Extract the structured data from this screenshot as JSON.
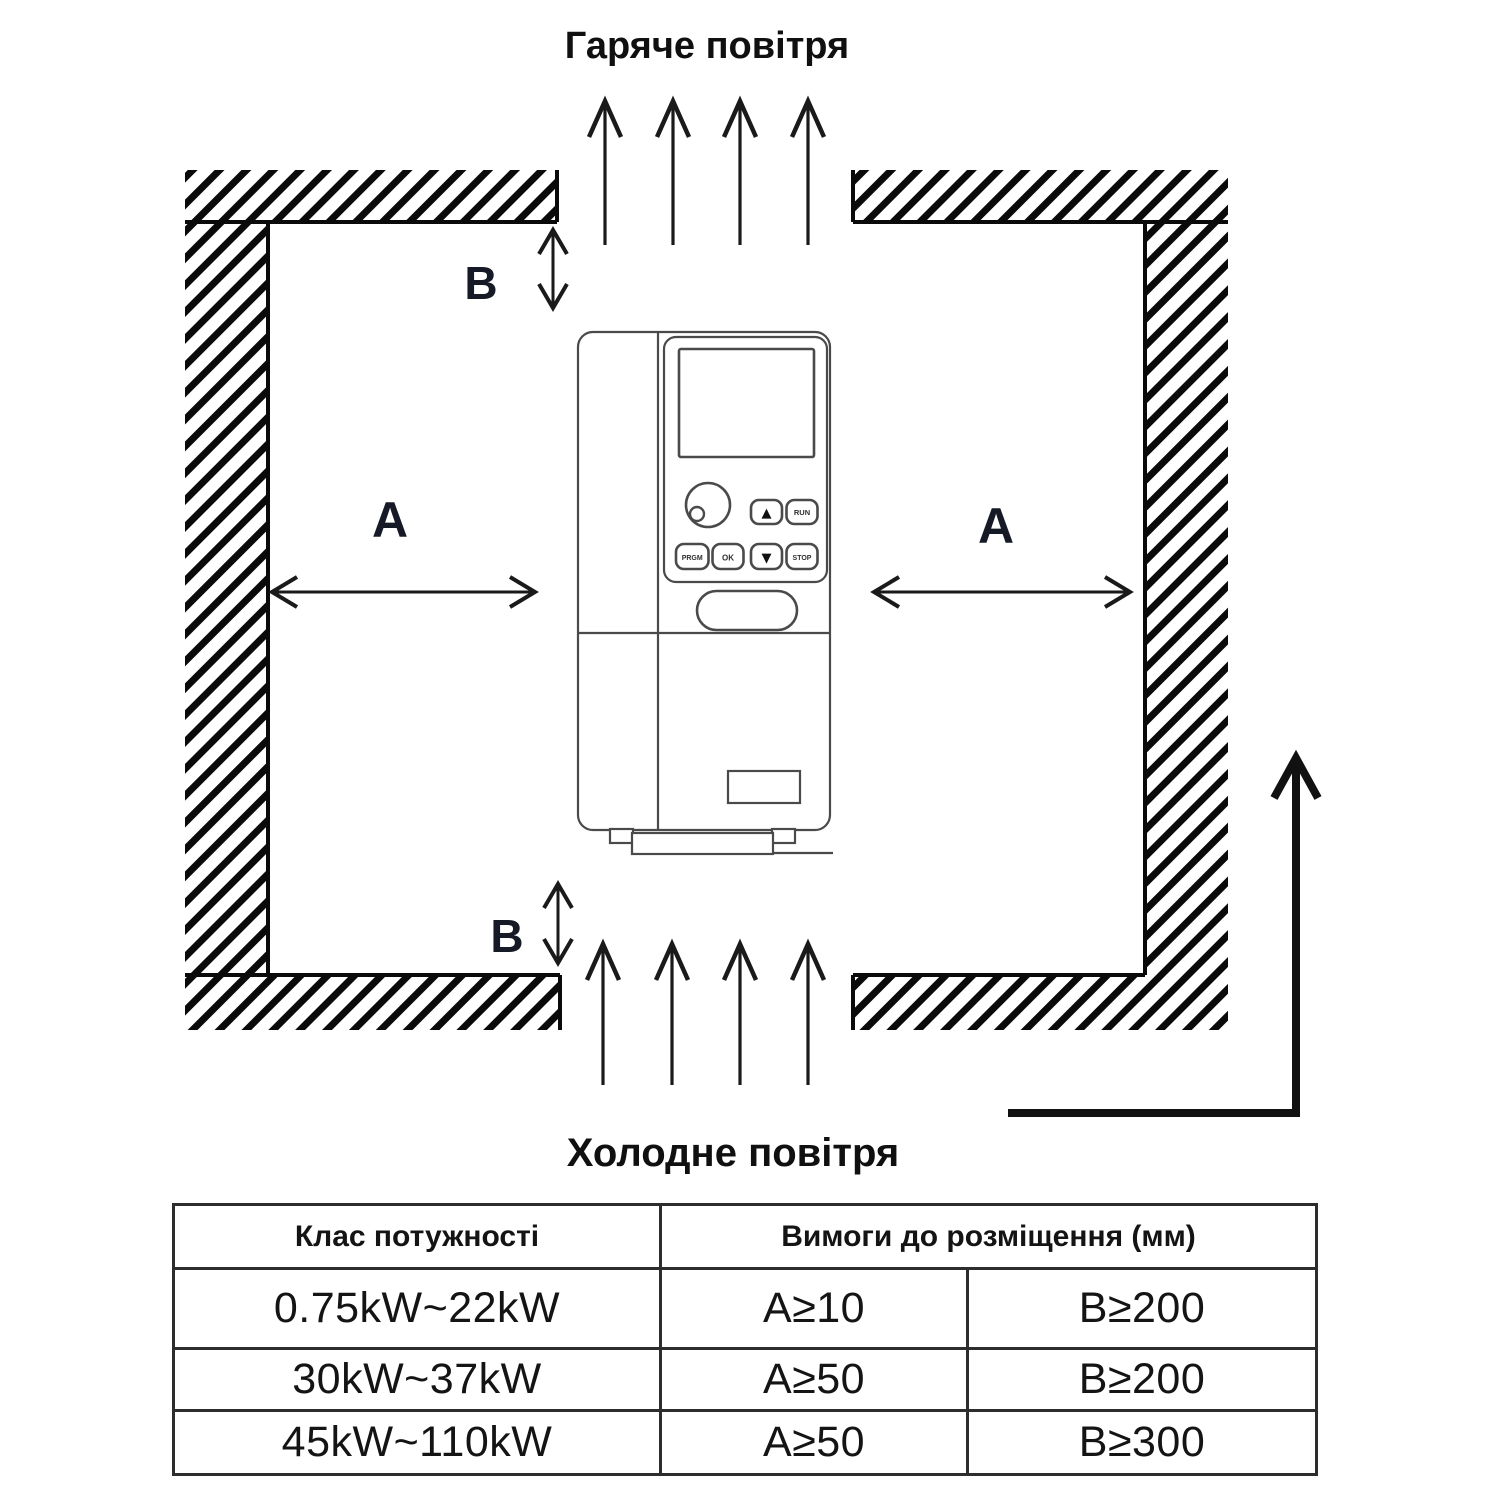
{
  "titles": {
    "hot_air": "Гаряче повітря",
    "cold_air": "Холодне повітря"
  },
  "dimension_labels": {
    "a_left": "A",
    "a_right": "A",
    "b_top": "B",
    "b_bottom": "B"
  },
  "device": {
    "btn_up": "▲",
    "btn_down": "▼",
    "btn_run": "RUN",
    "btn_prgm": "PRGM",
    "btn_ok": "OK",
    "btn_stop": "STOP"
  },
  "icons": {
    "up_flow_arrow": "arrow-up",
    "dimension_arrow": "double-headed-arrow",
    "airflow_path_arrow": "l-shaped-arrow-up"
  },
  "colors": {
    "line": "#1a1a1a",
    "label": "#161a26",
    "table_border": "#2d2d2d",
    "background": "#ffffff"
  },
  "table": {
    "col_power": "Клас потужності",
    "col_placement": "Вимоги до розміщення (мм)",
    "rows": [
      {
        "power": "0.75kW~22kW",
        "a": "A≥10",
        "b": "B≥200"
      },
      {
        "power": "30kW~37kW",
        "a": "A≥50",
        "b": "B≥200"
      },
      {
        "power": "45kW~110kW",
        "a": "A≥50",
        "b": "B≥300"
      }
    ]
  }
}
